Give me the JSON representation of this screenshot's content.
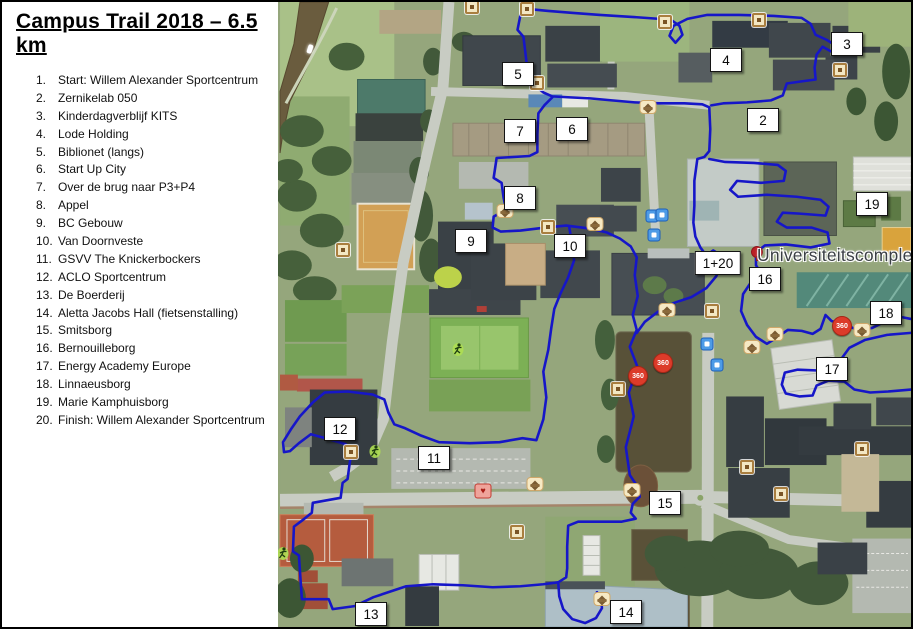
{
  "legend": {
    "title": "Campus Trail 2018 – 6.5 km",
    "items": [
      {
        "num": "1.",
        "label": "Start: Willem Alexander Sportcentrum"
      },
      {
        "num": "2.",
        "label": "Zernikelab 050"
      },
      {
        "num": "3.",
        "label": "Kinderdagverblijf KITS"
      },
      {
        "num": "4.",
        "label": "Lode Holding"
      },
      {
        "num": "5.",
        "label": "Biblionet (langs)"
      },
      {
        "num": "6.",
        "label": "Start Up City"
      },
      {
        "num": "7.",
        "label": "Over de brug naar P3+P4"
      },
      {
        "num": "8.",
        "label": "Appel"
      },
      {
        "num": "9.",
        "label": "BC Gebouw"
      },
      {
        "num": "10.",
        "label": "Van Doornveste"
      },
      {
        "num": "11.",
        "label": "GSVV The Knickerbockers"
      },
      {
        "num": "12.",
        "label": "ACLO Sportcentrum"
      },
      {
        "num": "13.",
        "label": "De Boerderij"
      },
      {
        "num": "14.",
        "label": "Aletta Jacobs Hall (fietsenstalling)"
      },
      {
        "num": "15.",
        "label": "Smitsborg"
      },
      {
        "num": "16.",
        "label": "Bernouilleborg"
      },
      {
        "num": "17.",
        "label": "Energy Academy Europe"
      },
      {
        "num": "18.",
        "label": "Linnaeusborg"
      },
      {
        "num": "19.",
        "label": "Marie Kamphuisborg"
      },
      {
        "num": "20.",
        "label": "Finish: Willem Alexander Sportcentrum"
      }
    ]
  },
  "map": {
    "place_label": "Universiteitscomplex",
    "route_color": "#1616c8",
    "markers": [
      {
        "label": "5",
        "x": 518,
        "y": 72
      },
      {
        "label": "7",
        "x": 520,
        "y": 129
      },
      {
        "label": "6",
        "x": 572,
        "y": 127
      },
      {
        "label": "8",
        "x": 520,
        "y": 196
      },
      {
        "label": "9",
        "x": 471,
        "y": 239
      },
      {
        "label": "10",
        "x": 570,
        "y": 244
      },
      {
        "label": "4",
        "x": 726,
        "y": 58
      },
      {
        "label": "3",
        "x": 847,
        "y": 42
      },
      {
        "label": "2",
        "x": 763,
        "y": 118
      },
      {
        "label": "19",
        "x": 872,
        "y": 202
      },
      {
        "label": "1+20",
        "x": 718,
        "y": 261
      },
      {
        "label": "16",
        "x": 765,
        "y": 277
      },
      {
        "label": "18",
        "x": 886,
        "y": 311
      },
      {
        "label": "17",
        "x": 832,
        "y": 367
      },
      {
        "label": "12",
        "x": 340,
        "y": 427
      },
      {
        "label": "11",
        "x": 434,
        "y": 456
      },
      {
        "label": "15",
        "x": 665,
        "y": 501
      },
      {
        "label": "13",
        "x": 371,
        "y": 612
      },
      {
        "label": "14",
        "x": 626,
        "y": 610
      }
    ],
    "icons": [
      {
        "type": "tan",
        "x": 472,
        "y": 5
      },
      {
        "type": "tan",
        "x": 527,
        "y": 7
      },
      {
        "type": "tan",
        "x": 665,
        "y": 20
      },
      {
        "type": "tan",
        "x": 759,
        "y": 18
      },
      {
        "type": "tan",
        "x": 537,
        "y": 81
      },
      {
        "type": "tan",
        "x": 840,
        "y": 68
      },
      {
        "type": "tan",
        "x": 343,
        "y": 248
      },
      {
        "type": "tan",
        "x": 351,
        "y": 450
      },
      {
        "type": "tan",
        "x": 548,
        "y": 225
      },
      {
        "type": "tan",
        "x": 517,
        "y": 530
      },
      {
        "type": "tan",
        "x": 618,
        "y": 387
      },
      {
        "type": "tan",
        "x": 747,
        "y": 465
      },
      {
        "type": "tan",
        "x": 781,
        "y": 492
      },
      {
        "type": "tan",
        "x": 862,
        "y": 447
      },
      {
        "type": "tan",
        "x": 712,
        "y": 309
      },
      {
        "type": "cap",
        "x": 505,
        "y": 209
      },
      {
        "type": "cap",
        "x": 595,
        "y": 222
      },
      {
        "type": "cap",
        "x": 648,
        "y": 105
      },
      {
        "type": "cap",
        "x": 667,
        "y": 308
      },
      {
        "type": "cap",
        "x": 752,
        "y": 345
      },
      {
        "type": "cap",
        "x": 775,
        "y": 332
      },
      {
        "type": "cap",
        "x": 862,
        "y": 328
      },
      {
        "type": "cap",
        "x": 535,
        "y": 482
      },
      {
        "type": "cap",
        "x": 632,
        "y": 488
      },
      {
        "type": "cap",
        "x": 602,
        "y": 597
      },
      {
        "type": "transit",
        "x": 652,
        "y": 214
      },
      {
        "type": "transit",
        "x": 662,
        "y": 213
      },
      {
        "type": "transit",
        "x": 654,
        "y": 233
      },
      {
        "type": "transit",
        "x": 707,
        "y": 342
      },
      {
        "type": "transit",
        "x": 717,
        "y": 363
      },
      {
        "type": "badge-360",
        "label": "360",
        "x": 842,
        "y": 324
      },
      {
        "type": "badge-360",
        "label": "360",
        "x": 663,
        "y": 361
      },
      {
        "type": "badge-360",
        "label": "360",
        "x": 638,
        "y": 374
      },
      {
        "type": "medical",
        "label": "♥",
        "x": 483,
        "y": 489
      },
      {
        "type": "pin",
        "x": 757,
        "y": 250
      },
      {
        "type": "player",
        "x": 458,
        "y": 350
      },
      {
        "type": "player",
        "x": 375,
        "y": 452
      },
      {
        "type": "player",
        "x": 283,
        "y": 554
      },
      {
        "type": "boat",
        "x": 310,
        "y": 47
      }
    ],
    "routes": [
      [
        [
          527,
          7
        ],
        [
          520,
          13
        ],
        [
          517,
          28
        ],
        [
          523,
          35
        ],
        [
          526,
          60
        ],
        [
          529,
          79
        ],
        [
          537,
          86
        ],
        [
          543,
          91
        ],
        [
          552,
          95
        ],
        [
          570,
          96
        ],
        [
          590,
          97
        ],
        [
          612,
          99
        ],
        [
          635,
          101
        ],
        [
          660,
          102
        ],
        [
          685,
          102
        ],
        [
          703,
          103
        ],
        [
          710,
          106
        ],
        [
          711,
          128
        ],
        [
          710,
          150
        ],
        [
          705,
          156
        ],
        [
          698,
          158
        ],
        [
          695,
          180
        ],
        [
          695,
          205
        ],
        [
          694,
          222
        ],
        [
          696,
          236
        ],
        [
          701,
          247
        ],
        [
          707,
          255
        ],
        [
          714,
          250
        ],
        [
          720,
          254
        ],
        [
          722,
          264
        ],
        [
          717,
          276
        ],
        [
          707,
          288
        ],
        [
          692,
          297
        ],
        [
          674,
          303
        ],
        [
          658,
          312
        ],
        [
          645,
          322
        ],
        [
          637,
          333
        ]
      ],
      [
        [
          527,
          7
        ],
        [
          548,
          9
        ],
        [
          573,
          11
        ],
        [
          600,
          13
        ],
        [
          632,
          15
        ],
        [
          660,
          17
        ],
        [
          673,
          19
        ],
        [
          680,
          24
        ],
        [
          683,
          33
        ],
        [
          676,
          41
        ],
        [
          670,
          34
        ],
        [
          674,
          24
        ],
        [
          688,
          17
        ],
        [
          708,
          13
        ],
        [
          740,
          13
        ],
        [
          775,
          14
        ],
        [
          803,
          16
        ],
        [
          812,
          22
        ],
        [
          817,
          33
        ],
        [
          828,
          38
        ],
        [
          838,
          44
        ],
        [
          833,
          50
        ],
        [
          824,
          45
        ],
        [
          818,
          53
        ],
        [
          816,
          66
        ],
        [
          817,
          78
        ],
        [
          802,
          80
        ],
        [
          788,
          82
        ],
        [
          784,
          94
        ],
        [
          772,
          99
        ],
        [
          748,
          101
        ],
        [
          724,
          102
        ],
        [
          712,
          104
        ]
      ],
      [
        [
          552,
          96
        ],
        [
          544,
          104
        ],
        [
          538,
          112
        ],
        [
          537,
          133
        ],
        [
          537,
          151
        ],
        [
          529,
          155
        ],
        [
          496,
          157
        ],
        [
          493,
          177
        ],
        [
          501,
          182
        ],
        [
          503,
          197
        ],
        [
          505,
          206
        ],
        [
          500,
          212
        ],
        [
          493,
          216
        ],
        [
          492,
          227
        ],
        [
          500,
          231
        ],
        [
          520,
          230
        ],
        [
          545,
          227
        ],
        [
          566,
          225
        ],
        [
          590,
          228
        ],
        [
          607,
          232
        ],
        [
          620,
          238
        ],
        [
          631,
          246
        ],
        [
          637,
          257
        ],
        [
          635,
          275
        ],
        [
          638,
          296
        ],
        [
          633,
          315
        ],
        [
          637,
          330
        ],
        [
          630,
          347
        ],
        [
          638,
          368
        ],
        [
          629,
          393
        ],
        [
          634,
          417
        ],
        [
          626,
          448
        ],
        [
          630,
          476
        ],
        [
          638,
          488
        ],
        [
          640,
          498
        ],
        [
          633,
          505
        ],
        [
          631,
          514
        ],
        [
          636,
          520
        ],
        [
          622,
          523
        ],
        [
          598,
          523
        ],
        [
          578,
          523
        ],
        [
          568,
          527
        ],
        [
          567,
          548
        ],
        [
          567,
          570
        ],
        [
          566,
          579
        ],
        [
          558,
          584
        ],
        [
          543,
          586
        ],
        [
          520,
          588
        ],
        [
          492,
          589
        ],
        [
          462,
          587
        ],
        [
          432,
          586
        ],
        [
          405,
          588
        ],
        [
          372,
          599
        ],
        [
          353,
          608
        ],
        [
          331,
          611
        ],
        [
          327,
          601
        ],
        [
          300,
          601
        ],
        [
          297,
          557
        ],
        [
          291,
          553
        ],
        [
          292,
          528
        ],
        [
          300,
          522
        ],
        [
          310,
          514
        ],
        [
          311,
          504
        ],
        [
          339,
          499
        ],
        [
          341,
          484
        ],
        [
          346,
          480
        ],
        [
          348,
          465
        ],
        [
          350,
          452
        ],
        [
          344,
          445
        ],
        [
          324,
          439
        ],
        [
          309,
          435
        ],
        [
          297,
          444
        ],
        [
          288,
          452
        ],
        [
          282,
          453
        ],
        [
          281,
          443
        ],
        [
          289,
          430
        ],
        [
          298,
          417
        ],
        [
          311,
          403
        ],
        [
          323,
          393
        ],
        [
          346,
          392
        ],
        [
          371,
          395
        ],
        [
          383,
          400
        ],
        [
          387,
          413
        ],
        [
          393,
          425
        ],
        [
          404,
          429
        ],
        [
          419,
          436
        ],
        [
          438,
          443
        ],
        [
          469,
          444
        ],
        [
          499,
          443
        ],
        [
          522,
          439
        ],
        [
          536,
          441
        ],
        [
          543,
          420
        ],
        [
          546,
          398
        ],
        [
          543,
          372
        ],
        [
          548,
          350
        ],
        [
          551,
          328
        ],
        [
          554,
          309
        ],
        [
          560,
          294
        ],
        [
          568,
          277
        ],
        [
          574,
          260
        ],
        [
          572,
          248
        ],
        [
          570,
          232
        ],
        [
          569,
          226
        ]
      ],
      [
        [
          710,
          158
        ],
        [
          726,
          161
        ],
        [
          755,
          162
        ],
        [
          779,
          164
        ],
        [
          787,
          170
        ],
        [
          785,
          180
        ],
        [
          762,
          182
        ],
        [
          738,
          180
        ],
        [
          731,
          189
        ],
        [
          739,
          196
        ],
        [
          768,
          194
        ],
        [
          798,
          196
        ],
        [
          822,
          199
        ],
        [
          830,
          206
        ],
        [
          827,
          215
        ],
        [
          801,
          213
        ],
        [
          784,
          212
        ],
        [
          778,
          221
        ],
        [
          788,
          227
        ],
        [
          813,
          227
        ],
        [
          829,
          232
        ],
        [
          831,
          243
        ],
        [
          812,
          247
        ],
        [
          787,
          244
        ],
        [
          766,
          245
        ],
        [
          757,
          252
        ],
        [
          757,
          265
        ],
        [
          763,
          274
        ],
        [
          752,
          282
        ],
        [
          744,
          294
        ],
        [
          742,
          311
        ],
        [
          748,
          325
        ],
        [
          757,
          337
        ],
        [
          768,
          344
        ],
        [
          779,
          337
        ],
        [
          789,
          330
        ],
        [
          803,
          331
        ],
        [
          814,
          334
        ],
        [
          822,
          329
        ],
        [
          827,
          315
        ],
        [
          833,
          321
        ],
        [
          846,
          325
        ],
        [
          860,
          330
        ],
        [
          874,
          328
        ],
        [
          888,
          321
        ],
        [
          903,
          317
        ],
        [
          913,
          319
        ]
      ],
      [
        [
          913,
          333
        ],
        [
          889,
          335
        ],
        [
          867,
          340
        ],
        [
          851,
          348
        ],
        [
          843,
          359
        ],
        [
          838,
          368
        ],
        [
          823,
          371
        ],
        [
          799,
          370
        ],
        [
          786,
          373
        ],
        [
          783,
          385
        ],
        [
          787,
          394
        ],
        [
          801,
          397
        ],
        [
          814,
          396
        ],
        [
          818,
          386
        ],
        [
          830,
          381
        ],
        [
          846,
          382
        ],
        [
          856,
          390
        ],
        [
          872,
          393
        ],
        [
          890,
          392
        ],
        [
          913,
          390
        ]
      ],
      [
        [
          558,
          584
        ],
        [
          559,
          598
        ],
        [
          563,
          611
        ],
        [
          572,
          621
        ],
        [
          585,
          625
        ],
        [
          596,
          620
        ],
        [
          602,
          610
        ],
        [
          601,
          600
        ],
        [
          597,
          594
        ]
      ]
    ]
  }
}
